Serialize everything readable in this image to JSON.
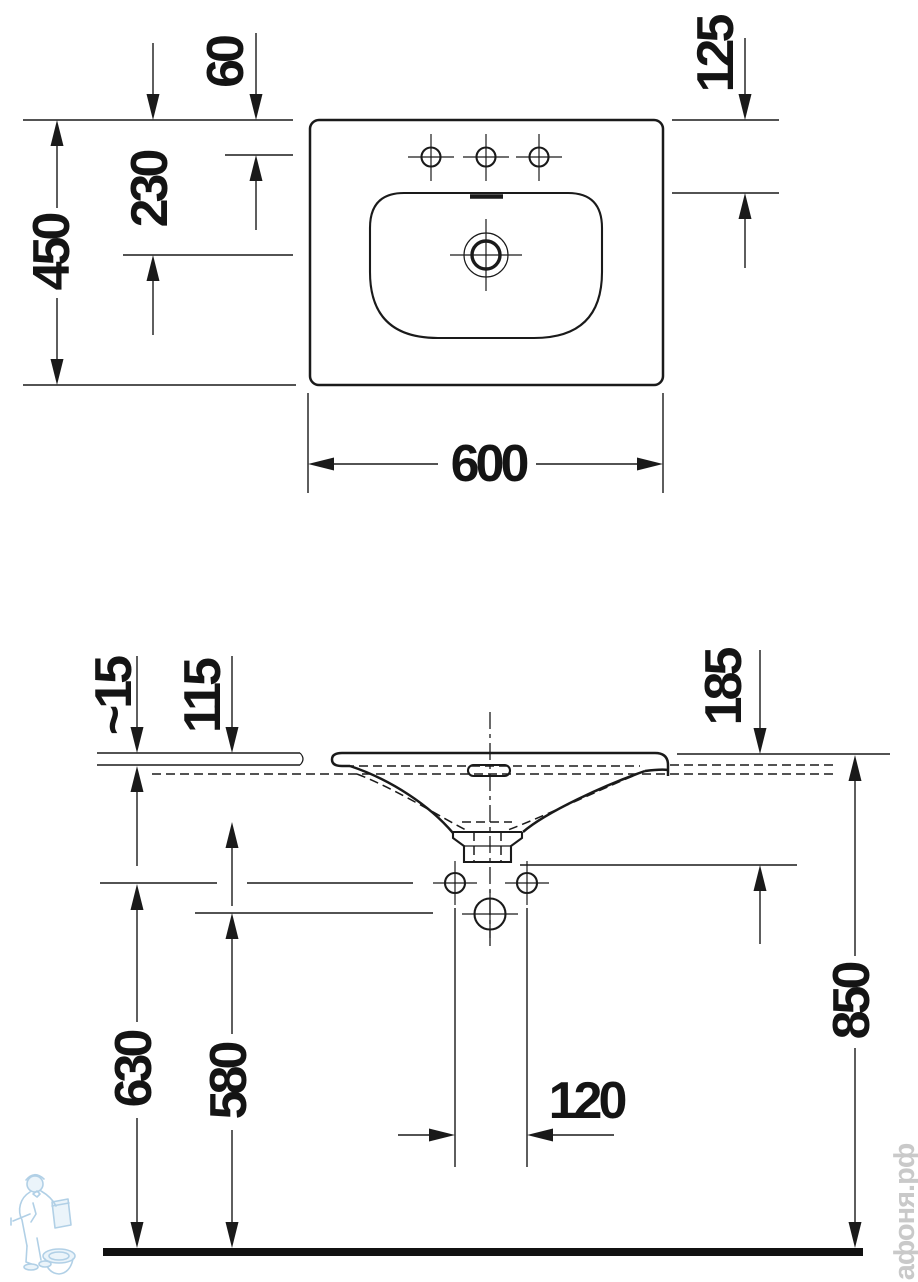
{
  "drawing_type": "washbasin-technical-drawing",
  "colors": {
    "line": "#1a1a1a",
    "watermark_blue": "#a9cbe4",
    "watermark_gray": "#c9c9c9"
  },
  "top_view": {
    "width": "600",
    "depth": "450",
    "tap_holes_offset": "60",
    "drain_offset": "230",
    "bowl_edge_offset": "125"
  },
  "side_view": {
    "rim_overhang": "~15",
    "bowl_depth": "115",
    "outlet_offset": "185",
    "fixing_holes_height": "630",
    "supply_height": "580",
    "fixing_holes_spacing": "120",
    "rim_height": "850"
  },
  "watermark": {
    "site_text": "афоня.рф"
  }
}
